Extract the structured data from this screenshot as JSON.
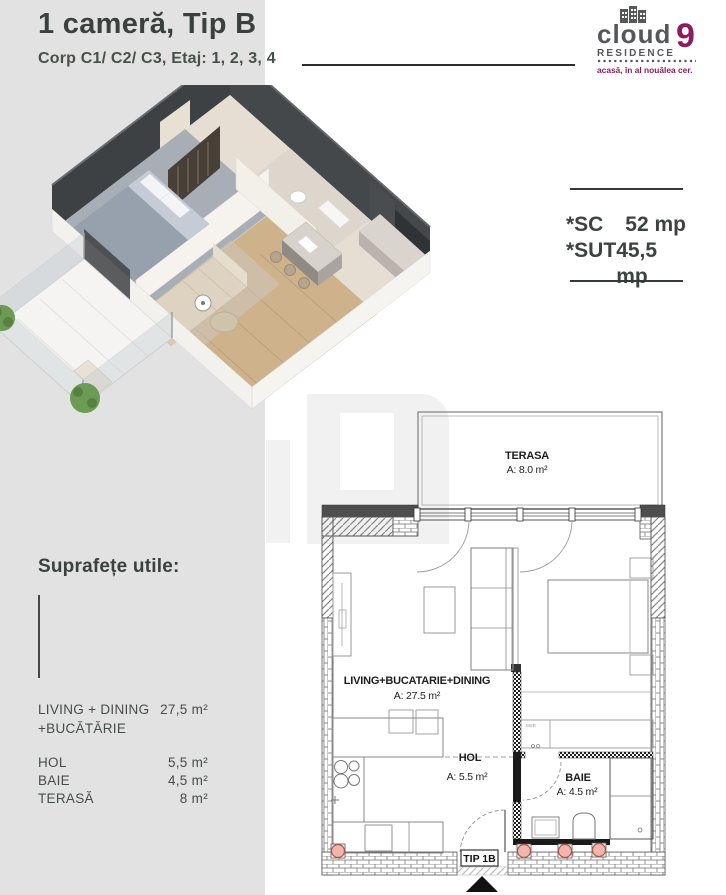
{
  "header": {
    "title": "1 cameră, Tip B",
    "subtitle": "Corp C1/ C2/ C3, Etaj: 1, 2, 3, 4"
  },
  "logo": {
    "word": "cloud",
    "nine": "9",
    "residence": "RESIDENCE",
    "tagline": "acasă, în al nouălea cer.",
    "accent_color": "#8e1b5e",
    "gray_color": "#55575b"
  },
  "area_summary": {
    "sc_label": "*SC",
    "sc_value": "52 mp",
    "sut_label": "*SUT",
    "sut_value": "45,5 mp"
  },
  "surfaces": {
    "heading": "Suprafețe utile:",
    "rows": [
      {
        "label_line1": "LIVING + DINING",
        "label_line2": "+BUCĂTĂRIE",
        "value": "27,5 m²"
      },
      {
        "label_line1": "HOL",
        "value": "5,5 m²"
      },
      {
        "label_line1": "BAIE",
        "value": "4,5 m²"
      },
      {
        "label_line1": "TERASĂ",
        "value": "8 m²"
      }
    ]
  },
  "floorplan": {
    "type_label": "TIP 1B",
    "annotation": "MSR",
    "rooms": {
      "terasa": {
        "name": "TERASA",
        "area": "A: 8.0 m²"
      },
      "living": {
        "name": "LIVING+BUCATARIE+DINING",
        "area": "A: 27.5 m²"
      },
      "hol": {
        "name": "HOL",
        "area": "A: 5.5 m²"
      },
      "baie": {
        "name": "BAIE",
        "area": "A: 4.5 m²"
      }
    }
  }
}
